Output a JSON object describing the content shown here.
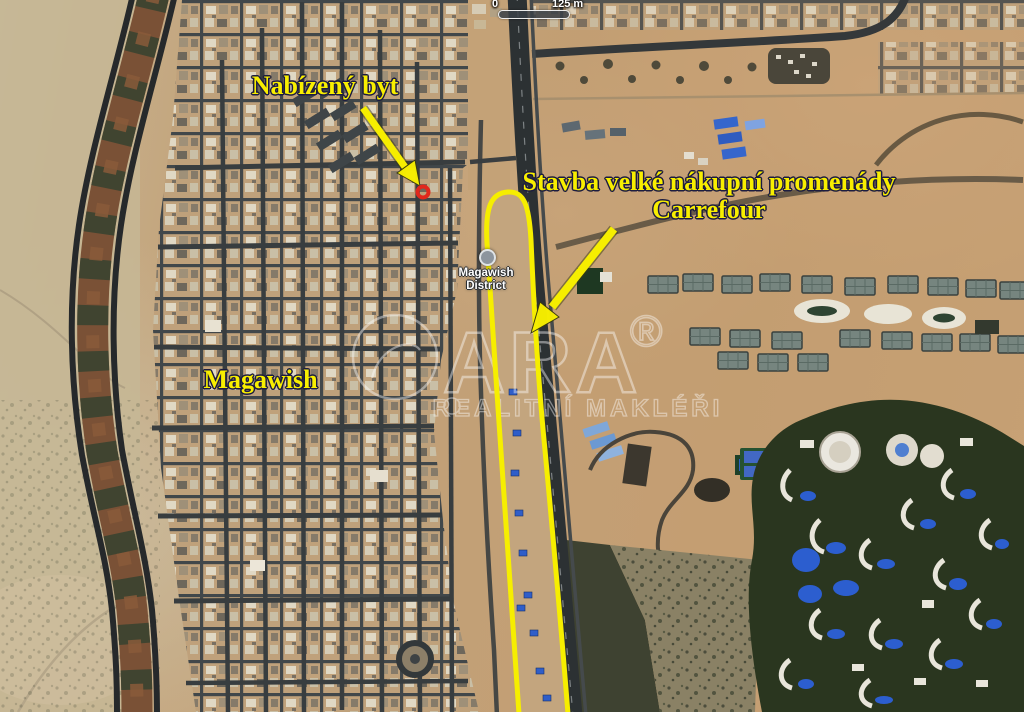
{
  "map": {
    "type": "satellite-map-screenshot",
    "scale_bar": {
      "zero_label": "0",
      "distance_label": "125 m"
    },
    "place_label": {
      "line1": "Magawish",
      "line2": "District"
    },
    "annotations": {
      "apartment": {
        "label": "Nabízený byt"
      },
      "promenade": {
        "line1": "Stavba velké nákupní promenády",
        "line2": "Carrefour"
      },
      "district_name": {
        "label": "Magawish"
      }
    },
    "watermark": {
      "brand": "ARA",
      "registered_mark": "®",
      "tagline": "REALITNÍ MAKLÉŘI"
    },
    "colors": {
      "annotation_yellow": "#f8ee00",
      "marker_red": "#e1271c",
      "route_highlight": "#f6ee00"
    }
  }
}
